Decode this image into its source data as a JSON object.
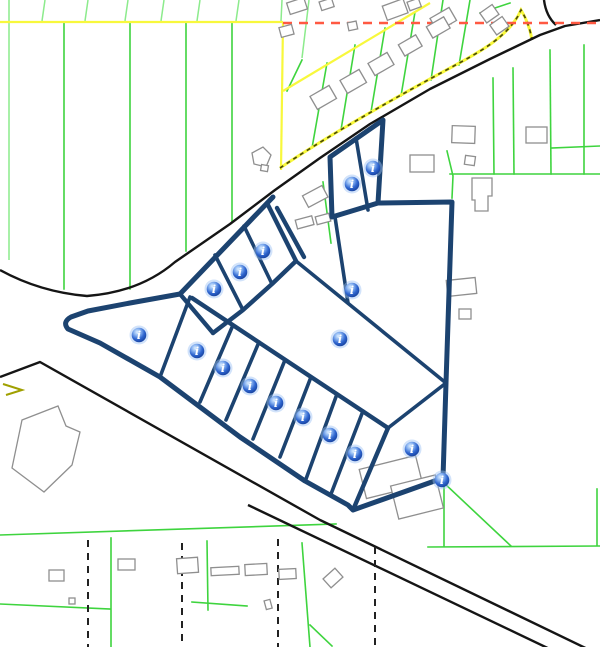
{
  "map": {
    "type": "cadastral-parcel-map",
    "canvas": {
      "width": 600,
      "height": 647
    },
    "colors": {
      "background": "#ffffff",
      "parcel_line": "#3ed43e",
      "parcel_line_light": "#8ceb8c",
      "selected_parcel": "#1c4370",
      "road_line": "#151515",
      "building_outline": "#8f8f8f",
      "boundary_red_dashed": "#ff5942",
      "boundary_yellow": "#f8f83c",
      "track_dash": "#4b4b07",
      "marker_core": "#1d50c0",
      "marker_highlight": "#e8f1ff",
      "marker_halo": "#9cc0f5"
    },
    "selection": {
      "style": "thick-navy-outline",
      "parcel_count": 17
    },
    "markers": {
      "icon": "info-marker-icon",
      "glyph": "i",
      "count": 17,
      "positions": [
        {
          "x": 373,
          "y": 168
        },
        {
          "x": 352,
          "y": 184
        },
        {
          "x": 263,
          "y": 251
        },
        {
          "x": 240,
          "y": 272
        },
        {
          "x": 214,
          "y": 289
        },
        {
          "x": 352,
          "y": 290
        },
        {
          "x": 340,
          "y": 339
        },
        {
          "x": 139,
          "y": 335
        },
        {
          "x": 197,
          "y": 351
        },
        {
          "x": 223,
          "y": 368
        },
        {
          "x": 250,
          "y": 386
        },
        {
          "x": 276,
          "y": 403
        },
        {
          "x": 303,
          "y": 417
        },
        {
          "x": 330,
          "y": 435
        },
        {
          "x": 355,
          "y": 454
        },
        {
          "x": 412,
          "y": 449
        },
        {
          "x": 442,
          "y": 480
        }
      ]
    }
  }
}
